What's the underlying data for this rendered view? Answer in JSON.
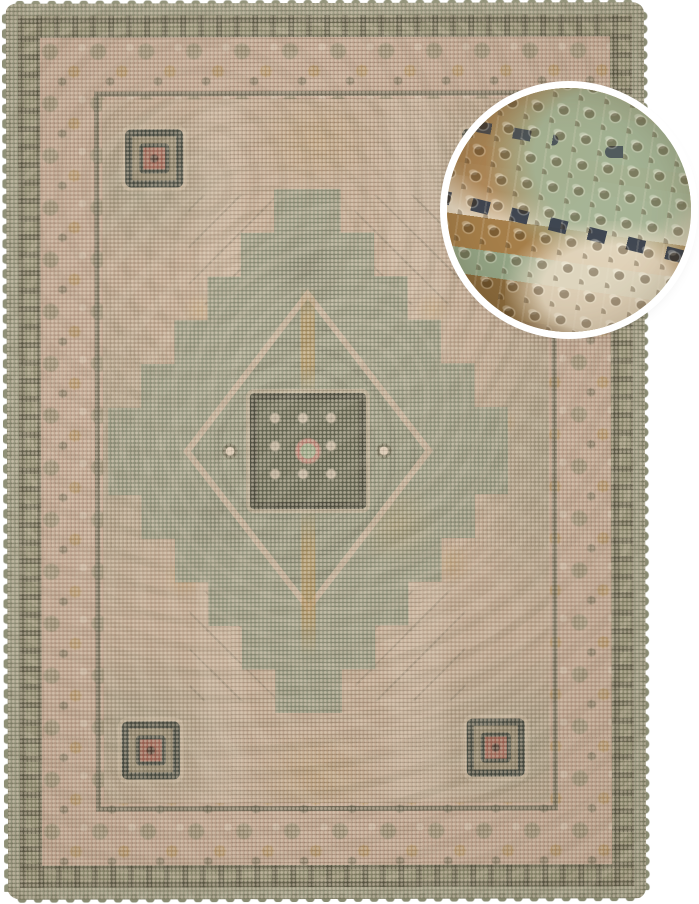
{
  "image": {
    "type": "product-photo",
    "alt": "Vintage oriental-style woven rug in sage green, beige and ochre on a white background, with a circular magnified detail of the weave at the top right",
    "background_color": "#ffffff"
  },
  "rug": {
    "description": "Rectangular vintage Persian-style rug with a central dark stepped medallion, four navy corner medallions with red centers, floral beige main border, olive ornament band and sage-green looped outer edge",
    "colors": {
      "field_beige": "#c3a78f",
      "sage_green": "#8e927a",
      "outer_band": "#9a9b82",
      "ornament_band_olive": "#8b8a6d",
      "main_border_beige": "#c7a893",
      "guard_stripe": "#5f5e4b",
      "medallion_panel": "#565a45",
      "medallion_panel_border": "#3b3d2f",
      "gold_ochre": "#b68b4a",
      "corner_navy": "#3a4038",
      "red_accent": "#9e5a4c",
      "cream": "#e6d8c4"
    }
  },
  "zoom_inset": {
    "description": "Circular close-up detail of the rug showing chunky woven loops in tan, brown, sage green and cream with a navy dashed stripe",
    "ring_color": "#ffffff",
    "colors": {
      "tan": "#ab8352",
      "brown": "#7c5c34",
      "sage": "#9db08e",
      "cream": "#e6d9c3",
      "navy": "#343c4a"
    }
  }
}
